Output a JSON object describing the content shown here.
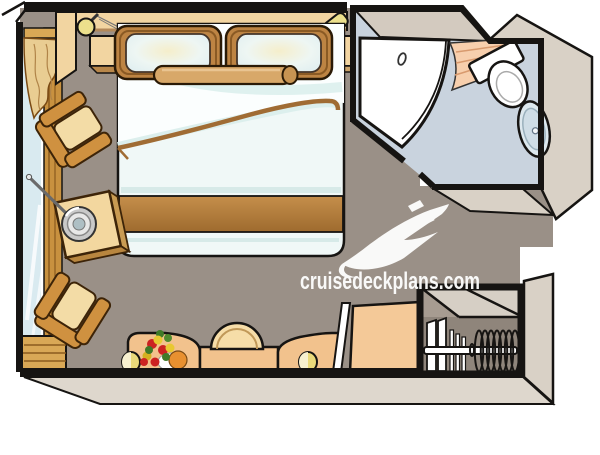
{
  "watermark": {
    "site": "cruisedeckplans.com",
    "logo": "cruise-ship-logo"
  },
  "floorplan": {
    "kind": "cruise stateroom floor plan (top view)",
    "areas": [
      "cabin",
      "bathroom",
      "wardrobe-closet"
    ],
    "furniture": [
      "double-bed",
      "framed-pillows",
      "bolster-pillow",
      "nightstand-left",
      "nightstand-right",
      "wall-lamp-left",
      "wall-lamp-right",
      "armchair-upper",
      "armchair-lower",
      "side-table",
      "ice-bucket",
      "champagne-bottle",
      "picture-window",
      "window-curtain",
      "vanity-desk",
      "stool",
      "flower-bouquet",
      "desk-lamp-left",
      "desk-lamp-right",
      "mirror-panel",
      "cabinet",
      "closet-rod",
      "hangers",
      "shower-door",
      "shower-curtain",
      "toilet",
      "sink"
    ],
    "colors": {
      "wall": "#161412",
      "floor": "#9a9087",
      "bathroom_floor": "#c9d3de",
      "wall_extrusion": "#d9d1c6",
      "wood": "#cf9140",
      "desk": "#f2c28d",
      "linen": "#f0f8f7",
      "bed_band": "#b8874a",
      "lamp_yellow": "#ece08c",
      "curtain_peach": "#f7cfad"
    }
  }
}
